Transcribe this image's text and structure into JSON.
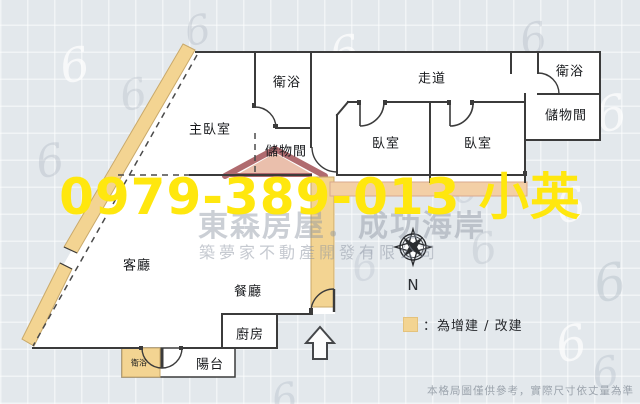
{
  "colors": {
    "background": "#e3e8ec",
    "floor": "#ffffff",
    "wall": "#3b3b3b",
    "addition_tan": "#f3d492",
    "addition_strip": "#f3cfa6",
    "phone_yellow": "#ffe70e",
    "logo_red": "#a85b60",
    "logo_fill": "#e8b9a4",
    "watermark_gray": "#8b94a1",
    "disclaimer_gray": "#9ba3ac"
  },
  "rooms": [
    {
      "id": "master-bedroom",
      "label": "主臥室"
    },
    {
      "id": "bathroom-top",
      "label": "衛浴"
    },
    {
      "id": "storage-center",
      "label": "儲物間"
    },
    {
      "id": "hallway",
      "label": "走道"
    },
    {
      "id": "bathroom-right",
      "label": "衛浴"
    },
    {
      "id": "storage-right",
      "label": "儲物間"
    },
    {
      "id": "bedroom-1",
      "label": "臥室"
    },
    {
      "id": "bedroom-2",
      "label": "臥室"
    },
    {
      "id": "living-room",
      "label": "客廳"
    },
    {
      "id": "dining-room",
      "label": "餐廳"
    },
    {
      "id": "kitchen",
      "label": "廚房"
    },
    {
      "id": "balcony",
      "label": "陽台"
    },
    {
      "id": "bathroom-small",
      "label": "衛浴"
    }
  ],
  "watermark": {
    "phone": "0979-389-013 小英",
    "brand_line1": "東森房屋．成功海岸",
    "brand_line2": "築夢家不動產開發有限公司"
  },
  "legend": {
    "label": "：為增建 / 改建"
  },
  "compass": {
    "label": "N"
  },
  "disclaimer": "本格局圖僅供參考，實際尺寸依丈量為準",
  "decor": {
    "glyph": "6"
  }
}
